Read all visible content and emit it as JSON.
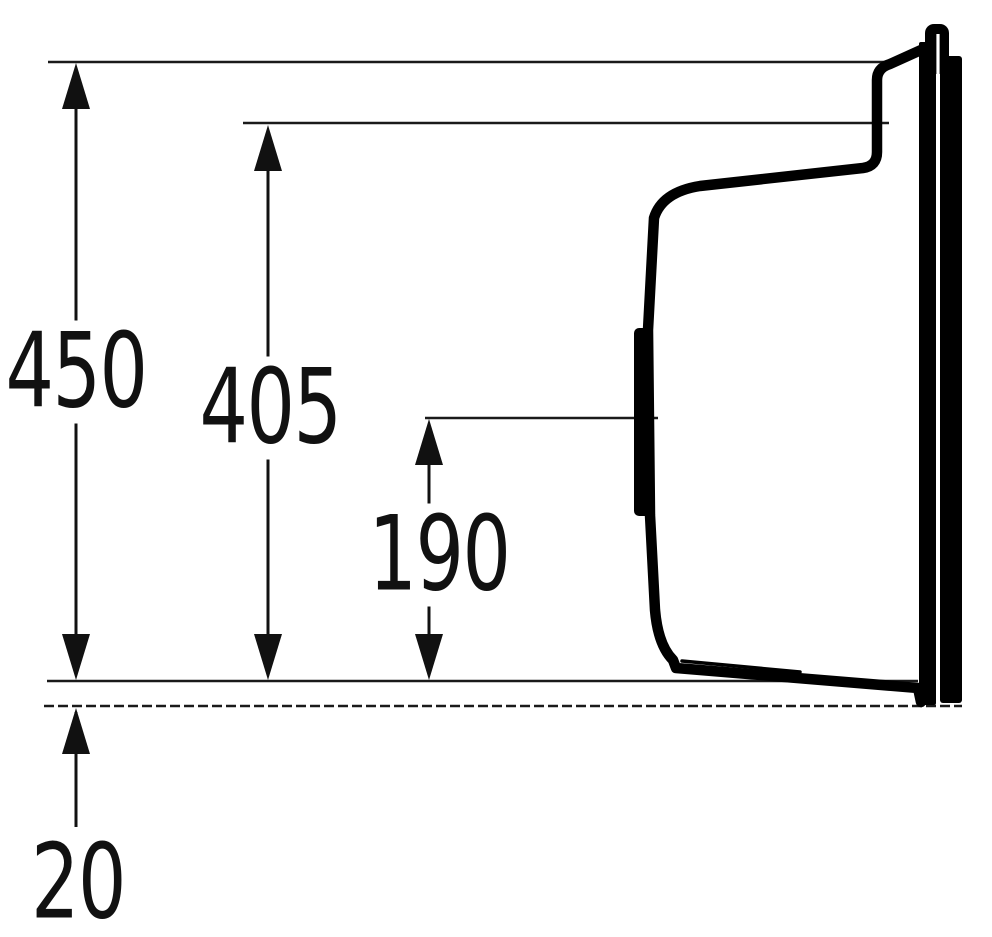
{
  "colors": {
    "ink": "#000000",
    "line": "#1a1a1a",
    "background": "#ffffff"
  },
  "dimensions": [
    {
      "value": "450"
    },
    {
      "value": "405"
    },
    {
      "value": "190"
    },
    {
      "value": "20"
    }
  ]
}
